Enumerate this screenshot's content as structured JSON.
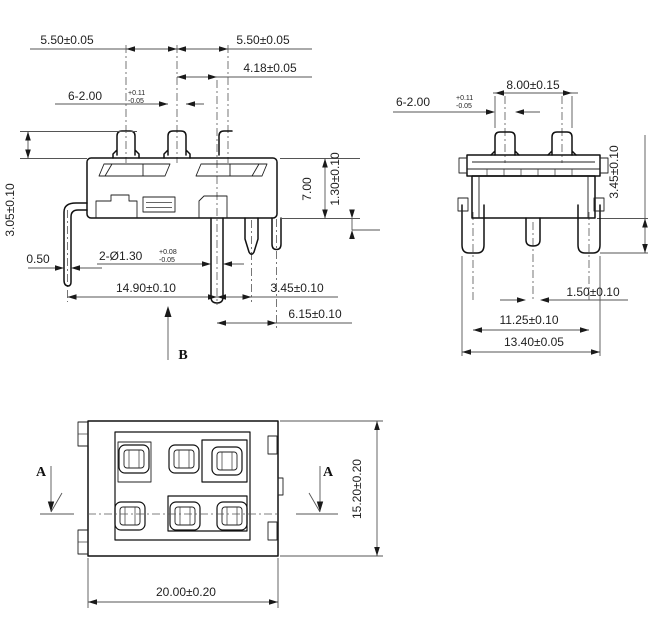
{
  "colors": {
    "background": "#ffffff",
    "outline": "#111111",
    "dimension_line": "#555555",
    "text": "#1f1f1f"
  },
  "front_view": {
    "dim_pitch_left": "5.50±0.05",
    "dim_pitch_right": "5.50±0.05",
    "dim_pin_offset": "4.18±0.05",
    "dim_pin_width": "6-2.00",
    "pin_width_tol_upper": "+0.11",
    "pin_width_tol_lower": "-0.05",
    "dim_height_above_body": "3.05±0.10",
    "dim_leg_thickness": "0.50",
    "dim_hole": "2-Ø1.30",
    "hole_tol_upper": "+0.08",
    "hole_tol_lower": "-0.05",
    "dim_body_width": "14.90±0.10",
    "dim_pin_gap": "3.45±0.10",
    "dim_leg_span": "6.15±0.10",
    "dim_body_height": "7.00",
    "dim_standoff": "1.30±0.10",
    "section_label": "B"
  },
  "side_view": {
    "dim_pin_width": "6-2.00",
    "pin_width_tol_upper": "+0.11",
    "pin_width_tol_lower": "-0.05",
    "dim_pin_pitch": "8.00±0.15",
    "dim_latch_height": "3.45±0.10",
    "dim_center_pin": "1.50±0.10",
    "dim_latch_span": "11.25±0.10",
    "dim_overall_width": "13.40±0.05"
  },
  "bottom_view": {
    "section_label_left": "A",
    "section_label_right": "A",
    "dim_height": "15.20±0.20",
    "dim_width": "20.00±0.20"
  }
}
